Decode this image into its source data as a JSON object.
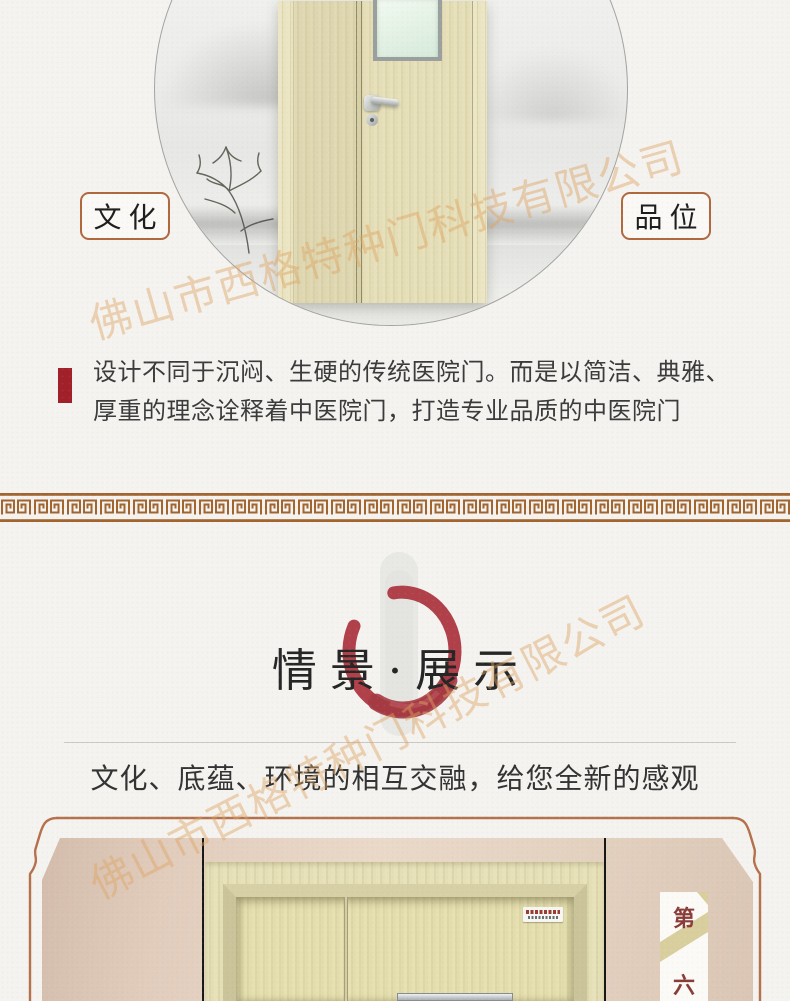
{
  "watermark": {
    "text": "佛山市西格特种门科技有限公司"
  },
  "hero": {
    "label_left": "文化",
    "label_right": "品位"
  },
  "intro": {
    "line1": "设计不同于沉闷、生硬的传统医院门。而是以简洁、典雅、",
    "line2": "厚重的理念诠释着中医院门，打造专业品质的中医院门"
  },
  "showcase": {
    "title": "情景·展示",
    "subtitle": "文化、底蕴、环境的相互交融，给您全新的感观",
    "badge_top": "第",
    "badge_bottom": "六"
  },
  "colors": {
    "accent_red": "#a2202a",
    "enso_red": "#b04049",
    "meander_brown": "#a2652f",
    "frame_brown": "#b4714b",
    "label_border": "#b0693f",
    "badge_text": "#8a3c39"
  }
}
